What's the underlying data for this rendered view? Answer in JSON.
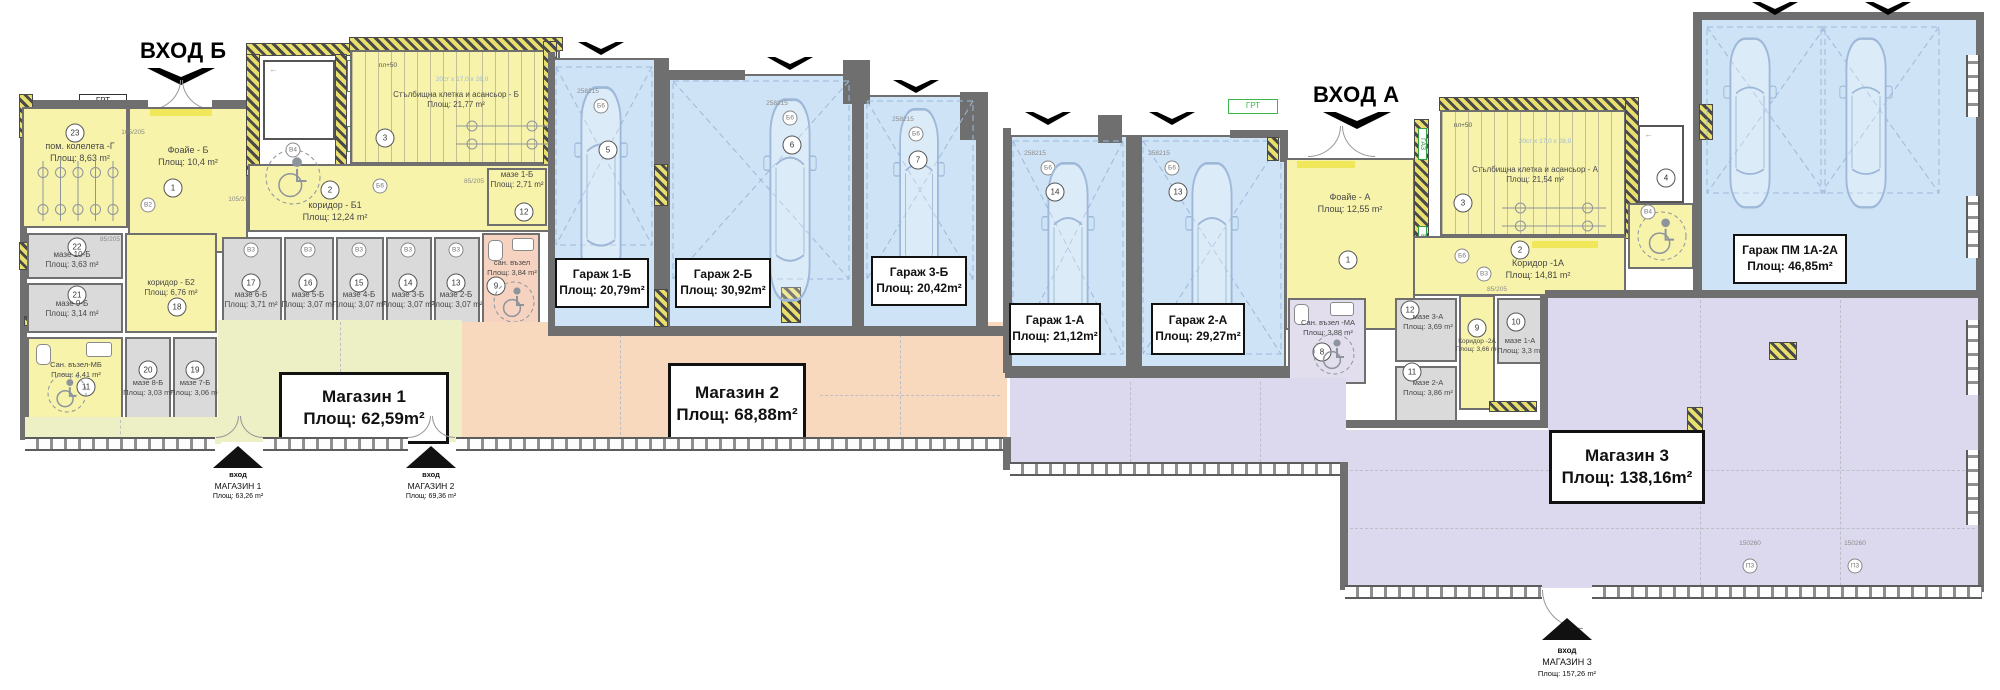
{
  "titles": {
    "entrance_b": "ВХОД Б",
    "entrance_a": "ВХОД А"
  },
  "shops": {
    "shop1": {
      "name": "Магазин 1",
      "area": "Площ: 62,59m²"
    },
    "shop2": {
      "name": "Магазин 2",
      "area": "Площ: 68,88m²"
    },
    "shop3": {
      "name": "Магазин 3",
      "area": "Площ: 138,16m²"
    }
  },
  "shop_entrances": {
    "e1": {
      "word": "вход",
      "name": "МАГАЗИН 1",
      "area": "Площ: 63,26 m²"
    },
    "e2": {
      "word": "вход",
      "name": "МАГАЗИН 2",
      "area": "Площ: 69,36 m²"
    },
    "e3": {
      "word": "вход",
      "name": "МАГАЗИН 3",
      "area": "Площ: 157,26 m²"
    }
  },
  "garages": {
    "g1b": {
      "num": "5",
      "name": "Гараж 1-Б",
      "area": "Площ: 20,79m²"
    },
    "g2b": {
      "num": "6",
      "name": "Гараж 2-Б",
      "area": "Площ: 30,92m²"
    },
    "g3b": {
      "num": "7",
      "name": "Гараж 3-Б",
      "area": "Площ: 20,42m²"
    },
    "g1a": {
      "num": "14",
      "name": "Гараж 1-А",
      "area": "Площ: 21,12m²"
    },
    "g2a": {
      "num": "13",
      "name": "Гараж 2-А",
      "area": "Площ: 29,27m²"
    },
    "gpm": {
      "name": "Гараж ПМ 1А-2А",
      "area": "Площ: 46,85m²"
    }
  },
  "wing_b": {
    "bike_room": {
      "num": "23",
      "name": "пом. колелета -Г",
      "area": "Площ: 8,63 m²"
    },
    "foyer": {
      "num": "1",
      "name": "Фоайе - Б",
      "area": "Площ: 10,4 m²"
    },
    "corridor1": {
      "num": "2",
      "name": "коридор - Б1",
      "area": "Площ: 12,24 m²"
    },
    "stairs": {
      "num": "3",
      "name": "Стълбищна клетка и асансьор - Б",
      "area": "Площ:   21,77 m²"
    },
    "maze10": {
      "num": "22",
      "name": "мазе 10-Б",
      "area": "Площ: 3,63 m²"
    },
    "maze9": {
      "num": "21",
      "name": "мазе 9-Б",
      "area": "Площ: 3,14 m²"
    },
    "corridor2": {
      "num": "18",
      "name": "коридор - Б2",
      "area": "Площ: 6,76 m²"
    },
    "maze6": {
      "num": "17",
      "name": "мазе 6-Б",
      "area": "Площ: 3,71 m²"
    },
    "maze5": {
      "num": "16",
      "name": "мазе 5-Б",
      "area": "Площ: 3,07 m²"
    },
    "maze4": {
      "num": "15",
      "name": "мазе 4-Б",
      "area": "Площ: 3,07 m²"
    },
    "maze3": {
      "num": "14",
      "name": "мазе 3-Б",
      "area": "Площ: 3,07 m²"
    },
    "maze2": {
      "num": "13",
      "name": "мазе 2-Б",
      "area": "Площ: 3,07 m²"
    },
    "maze1": {
      "num": "12",
      "name": "мазе 1-Б",
      "area": "Площ: 2,71 m²"
    },
    "san_mb": {
      "num": "11",
      "name": "Сан. възел-МБ",
      "area": "Площ: 4,41 m²"
    },
    "maze8": {
      "num": "20",
      "name": "мазе 8-Б",
      "area": "Площ: 3,03 m²"
    },
    "maze7": {
      "num": "19",
      "name": "мазе 7-Б",
      "area": "Площ: 3,06 m²"
    },
    "san9": {
      "num": "9",
      "name": "сан. възел",
      "area": "Площ: 3,84 m²"
    }
  },
  "wing_a": {
    "foyer": {
      "num": "1",
      "name": "Фоайе - А",
      "area": "Площ: 12,55 m²"
    },
    "stairs": {
      "num": "3",
      "name": "Стълбищна клетка и асансьор - А",
      "area": "Площ:   21,54 m²"
    },
    "corridor1": {
      "num": "2",
      "name": "Коридор -1А",
      "area": "Площ: 14,81 m²"
    },
    "san_ma": {
      "num": "8",
      "name": "Сан. възел -МА",
      "area": "Площ: 3,88 m²"
    },
    "maze3a": {
      "num": "12",
      "name": "мазе 3-А",
      "area": "Площ: 3,69 m²"
    },
    "maze2a": {
      "num": "11",
      "name": "мазе 2-А",
      "area": "Площ: 3,86 m²"
    },
    "corridor2": {
      "num": "9",
      "name": "Коридор -2А",
      "area": "Площ: 3,66 m²"
    },
    "maze1a": {
      "num": "10",
      "name": "мазе 1-А",
      "area": "Площ: 3,3 m²"
    },
    "elevator": {
      "num": "4"
    }
  },
  "annotations": {
    "grt": "ГРТ",
    "gaz": "ГАЗ",
    "el": "ЕЛ",
    "pl50": "пл+50",
    "stair_dim": "20ст x 17,0 x 28,0",
    "d85": "85/205",
    "d105": "105/205",
    "d258": "258",
    "d215": "215",
    "d150": "150",
    "d260": "260",
    "p3": "П3",
    "b2": "B2",
    "b3": "B3",
    "b4": "B4",
    "b6": "Б6"
  },
  "colors": {
    "wall": "#6f6f6f",
    "yellow": "#f7f3ab",
    "garage_blue": "#cfe3f6",
    "shop1": "#edefc5",
    "shop2": "#f8d9bd",
    "shop3": "#dcd9ee",
    "basement_gray": "#dadada",
    "green": "#3cb54a"
  }
}
